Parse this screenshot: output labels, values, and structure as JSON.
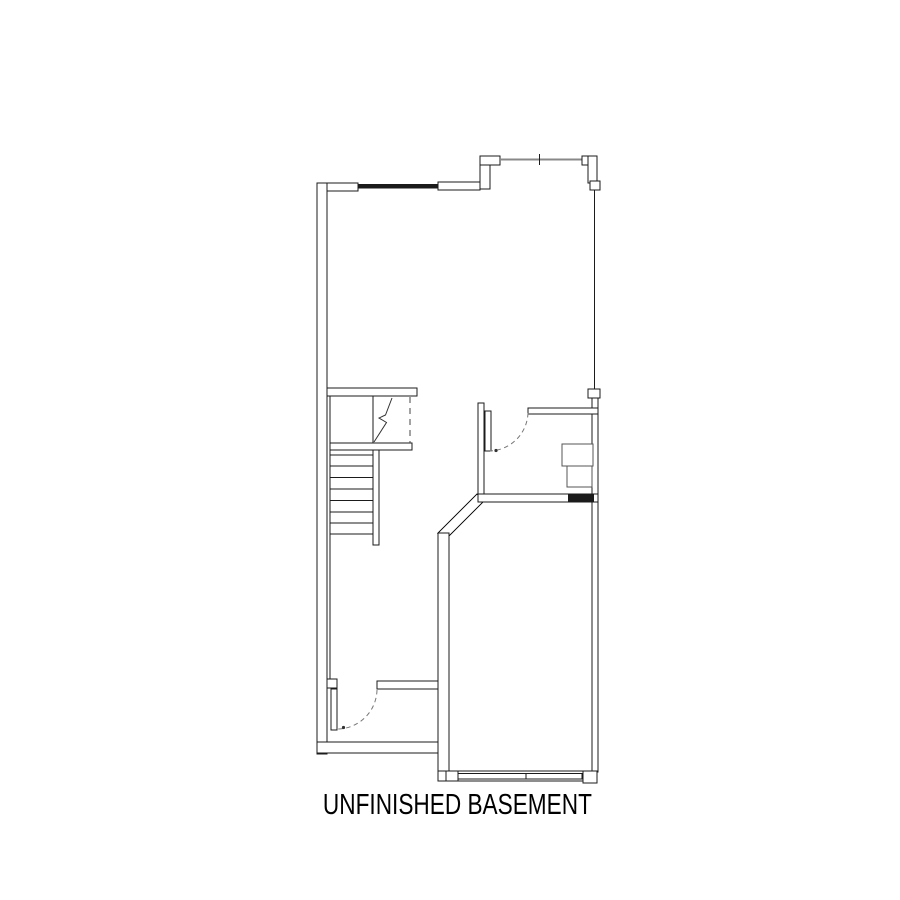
{
  "page": {
    "background_color": "#ffffff",
    "ink_color": "#1b1b1b",
    "window_line_color": "#888888",
    "fixture_line_color": "#555555"
  },
  "plan": {
    "title": "UNFINISHED BASEMENT",
    "drawing_type": "architectural floor plan",
    "features": [
      "exterior-walls",
      "top-window",
      "staircase-8-treads",
      "stair-break-line",
      "headroom-dashed-line",
      "interior-door-swing",
      "understair-room-door-swing",
      "furnace-unit",
      "masonry-block",
      "angled-wall",
      "bottom-window"
    ]
  }
}
